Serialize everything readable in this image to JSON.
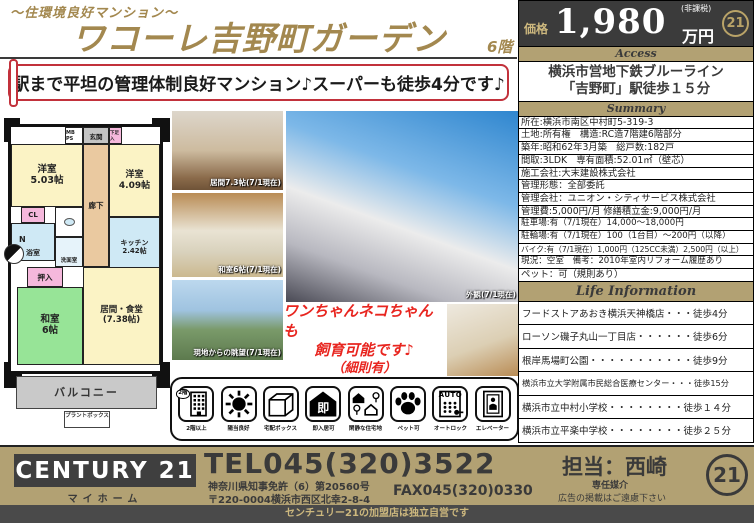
{
  "header": {
    "tagline": "～住環境良好マンション～",
    "title": "ワコーレ吉野町ガーデン",
    "floor": "6階",
    "catch_copy": "駅まで平坦の管理体制良好マンション♪スーパーも徒歩4分です♪"
  },
  "price": {
    "label": "価格",
    "value": "1,980",
    "unit": "万円",
    "tax_note": "(非課税)",
    "seal": "21"
  },
  "access": {
    "heading": "Access",
    "line1": "横浜市営地下鉄ブルーライン",
    "line2": "「吉野町」駅徒歩１５分"
  },
  "summary": {
    "heading": "Summary",
    "rows": [
      "所在:横浜市南区中村町5-319-3",
      "土地:所有権　構造:RC造7階建6階部分",
      "築年:昭和62年3月築　総戸数:182戸",
      "間取:3LDK　専有面積:52.01㎡（壁芯）",
      "施工会社:大末建設株式会社",
      "管理形態：全部委託",
      "管理会社：ユニオン・シティサービス株式会社",
      "管理費:5,000円/月 修繕積立金:9,000円/月",
      "駐車場:有（7/1現在）14,000～18,000円",
      "駐輪場:有（7/1現在）100（1台目）～200円（以降）",
      "バイク:有（7/1現在）1,000円（125CC未満）2,500円（以上）",
      "現況：空室　備考：2010年室内リフォーム履歴あり",
      "ペット：可（規則あり）"
    ]
  },
  "life": {
    "heading": "Life Information",
    "rows": [
      "フードストアあおき横浜天神橋店・・・徒歩4分",
      "ローソン磯子丸山一丁目店・・・・・・徒歩6分",
      "根岸馬場町公園・・・・・・・・・・・徒歩9分",
      "横浜市立大学附属市民総合医療センター・・・徒歩15分",
      "横浜市立中村小学校・・・・・・・・徒歩１４分",
      "横浜市立平楽中学校・・・・・・・・徒歩２５分"
    ]
  },
  "floorplan": {
    "mbps": "MB PS",
    "genkan": "玄関",
    "shoe": "下足入",
    "west1_name": "洋室",
    "west1_size": "5.03帖",
    "hall": "廊下",
    "west2_name": "洋室",
    "west2_size": "4.09帖",
    "cl": "CL",
    "bath": "浴室",
    "wash": "洗面室",
    "kitchen_name": "キッチン",
    "kitchen_size": "2.42帖",
    "oshiire": "押入",
    "washitsu_name": "和室",
    "washitsu_size": "6帖",
    "living_name": "居間・食堂",
    "living_size": "(7.38帖)",
    "balcony": "バルコニー",
    "plantbox": "プラントボックス",
    "compass_n": "N"
  },
  "photos": {
    "living_caption": "居間7.3帖(7/1現在)",
    "washitsu_caption": "和室6帖(7/1現在)",
    "view_caption": "現地からの眺望(7/1現在)",
    "exterior_caption": "外観(7/1現在)"
  },
  "pets_note": {
    "line1": "ワンちゃんネコちゃんも",
    "line2": "飼育可能です♪",
    "line3": "（細則有）"
  },
  "features": {
    "items": [
      {
        "label": "2階以上",
        "glyph": "2階"
      },
      {
        "label": "陽当良好"
      },
      {
        "label": "宅配ボックス"
      },
      {
        "label": "即入居可",
        "glyph": "即"
      },
      {
        "label": "閑静な住宅地"
      },
      {
        "label": "ペット可"
      },
      {
        "label": "オートロック",
        "glyph": "AUTO"
      },
      {
        "label": "エレベーター"
      }
    ]
  },
  "footer": {
    "brand": "CENTURY 21",
    "brand_sub": "マイホーム",
    "tel": "TEL045(320)3522",
    "license": "神奈川県知事免許（6）第20560号",
    "address": "〒220-0004横浜市西区北幸2-8-4",
    "fax": "FAX045(320)0330",
    "agent": "担当：西崎",
    "mediation": "専任媒介",
    "ad_note": "広告の掲載はご遠慮下さい",
    "seal": "21",
    "disclaimer": "センチュリー21の加盟店は独立自営です"
  }
}
